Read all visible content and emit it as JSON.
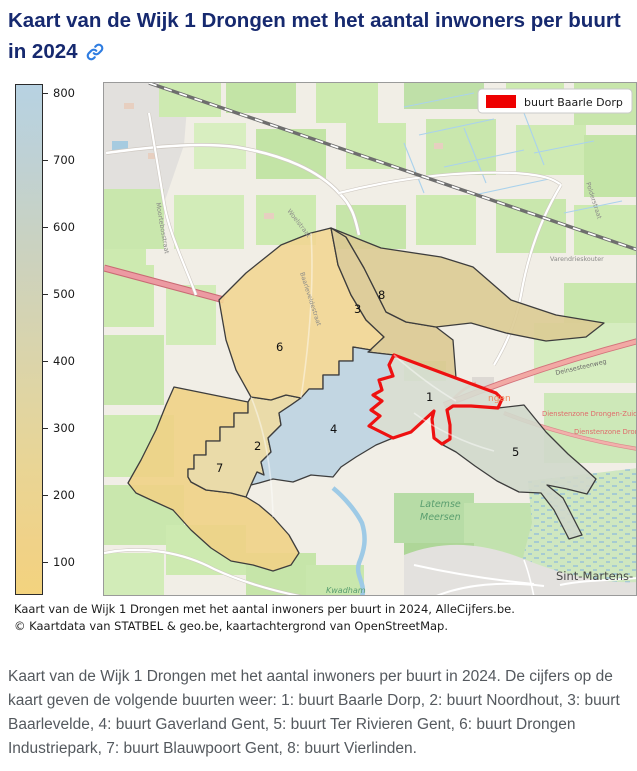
{
  "title": {
    "text": "Kaart van de Wijk 1 Drongen met het aantal inwoners per buurt in 2024",
    "link_icon": "link-icon",
    "color": "#16296f"
  },
  "legend": {
    "label": "buurt Baarle Dorp",
    "swatch_color": "#ee0000"
  },
  "colorbar": {
    "ticks": [
      800,
      700,
      600,
      500,
      400,
      300,
      200,
      100
    ],
    "top_color": "#b7d2e2",
    "bottom_color": "#f3d37e"
  },
  "map": {
    "regions": [
      {
        "number": "1",
        "name": "buurt Baarle Dorp",
        "fill": "#d6dbd0",
        "outline": "#ee1111"
      },
      {
        "number": "2",
        "name": "buurt Noordhout",
        "fill": "#e9d8a2",
        "outline": "#3d3d3d"
      },
      {
        "number": "3",
        "name": "buurt Baarlevelde",
        "fill": "#dcc992",
        "outline": "#3d3d3d"
      },
      {
        "number": "4",
        "name": "buurt Gaverland Gent",
        "fill": "#bdd3e1",
        "outline": "#3d3d3d"
      },
      {
        "number": "5",
        "name": "buurt Ter Rivieren Gent",
        "fill": "#d0d8cb",
        "outline": "#3d3d3d"
      },
      {
        "number": "6",
        "name": "buurt Drongen Industriepark",
        "fill": "#f2d694",
        "outline": "#3d3d3d"
      },
      {
        "number": "7",
        "name": "buurt Blauwpoort Gent",
        "fill": "#f0d186",
        "outline": "#3d3d3d"
      },
      {
        "number": "8",
        "name": "buurt Vierlinden",
        "fill": "#dccb93",
        "outline": "#3d3d3d"
      }
    ],
    "labels": [
      {
        "text": "Woelstraat"
      },
      {
        "text": "Moortebosstraat"
      },
      {
        "text": "Baarleveldestraat"
      },
      {
        "text": "Varendrieskouter"
      },
      {
        "text": "Polderstraat"
      },
      {
        "text": "Deinsesteenweg"
      },
      {
        "text": "Dienstenzone Drongen-Zuid"
      },
      {
        "text": "Dienstenzone Dronge"
      },
      {
        "text": "ngen"
      },
      {
        "text": "Latemse"
      },
      {
        "text": "Meersen"
      },
      {
        "text": "Kwadham"
      },
      {
        "text": "Sint-Martens-"
      }
    ]
  },
  "caption": {
    "line1": "Kaart van de Wijk 1 Drongen met het aantal inwoners per buurt in 2024, AlleCijfers.be.",
    "line2": "© Kaartdata van STATBEL & geo.be, kaartachtergrond van OpenStreetMap."
  },
  "description": "Kaart van de Wijk 1 Drongen met het aantal inwoners per buurt in 2024. De cijfers op de kaart geven de volgende buurten weer: 1: buurt Baarle Dorp, 2: buurt Noordhout, 3: buurt Baarlevelde, 4: buurt Gaverland Gent, 5: buurt Ter Rivieren Gent, 6: buurt Drongen Industriepark, 7: buurt Blauwpoort Gent, 8: buurt Vierlinden."
}
